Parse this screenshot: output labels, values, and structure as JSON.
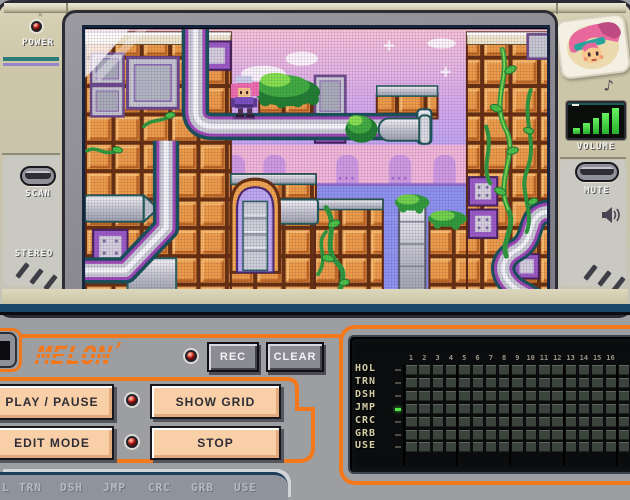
{
  "console": {
    "power_label": "POWER",
    "scan_label": "SCAN",
    "stereo_label": "STEREO",
    "volume_label": "VOLUME",
    "mute_label": "MUTE",
    "music_note": "♪",
    "volume_bars": 5,
    "accent_teal": "#2a7d78",
    "accent_purple": "#9387c9",
    "shell_color": "#cbc4a8",
    "led_color": "#ee3c2c"
  },
  "game_screen": {
    "description": "pixel platformer level",
    "palette": {
      "brick": "#ec9c46",
      "sky_top": "#f6c3d8",
      "sky_bottom": "#8e94ee",
      "vine": "#3fae3f",
      "pipe": "#c9ccd4",
      "water": "#8d93ee"
    },
    "character": "pink-haired girl sprite"
  },
  "control_panel": {
    "logo": "MELON",
    "rec_label": "REC",
    "clear_label": "CLEAR",
    "play_pause_label": "PLAY / PAUSE",
    "show_grid_label": "SHOW GRID",
    "edit_mode_label": "EDIT MODE",
    "stop_label": "STOP",
    "accent_orange": "#f3781c",
    "button_face": "#f8cfa6"
  },
  "tracker": {
    "rows": [
      "HOL",
      "TRN",
      "DSH",
      "JMP",
      "CRC",
      "GRB",
      "USE"
    ],
    "columns": [
      "1",
      "2",
      "3",
      "4",
      "5",
      "6",
      "7",
      "8",
      "9",
      "10",
      "11",
      "12",
      "13",
      "14",
      "15",
      "16"
    ],
    "active_row": "JMP"
  },
  "bottom_strip": {
    "labels": [
      "L",
      "TRN",
      "DSH",
      "JMP",
      "CRC",
      "GRB",
      "USE"
    ]
  }
}
